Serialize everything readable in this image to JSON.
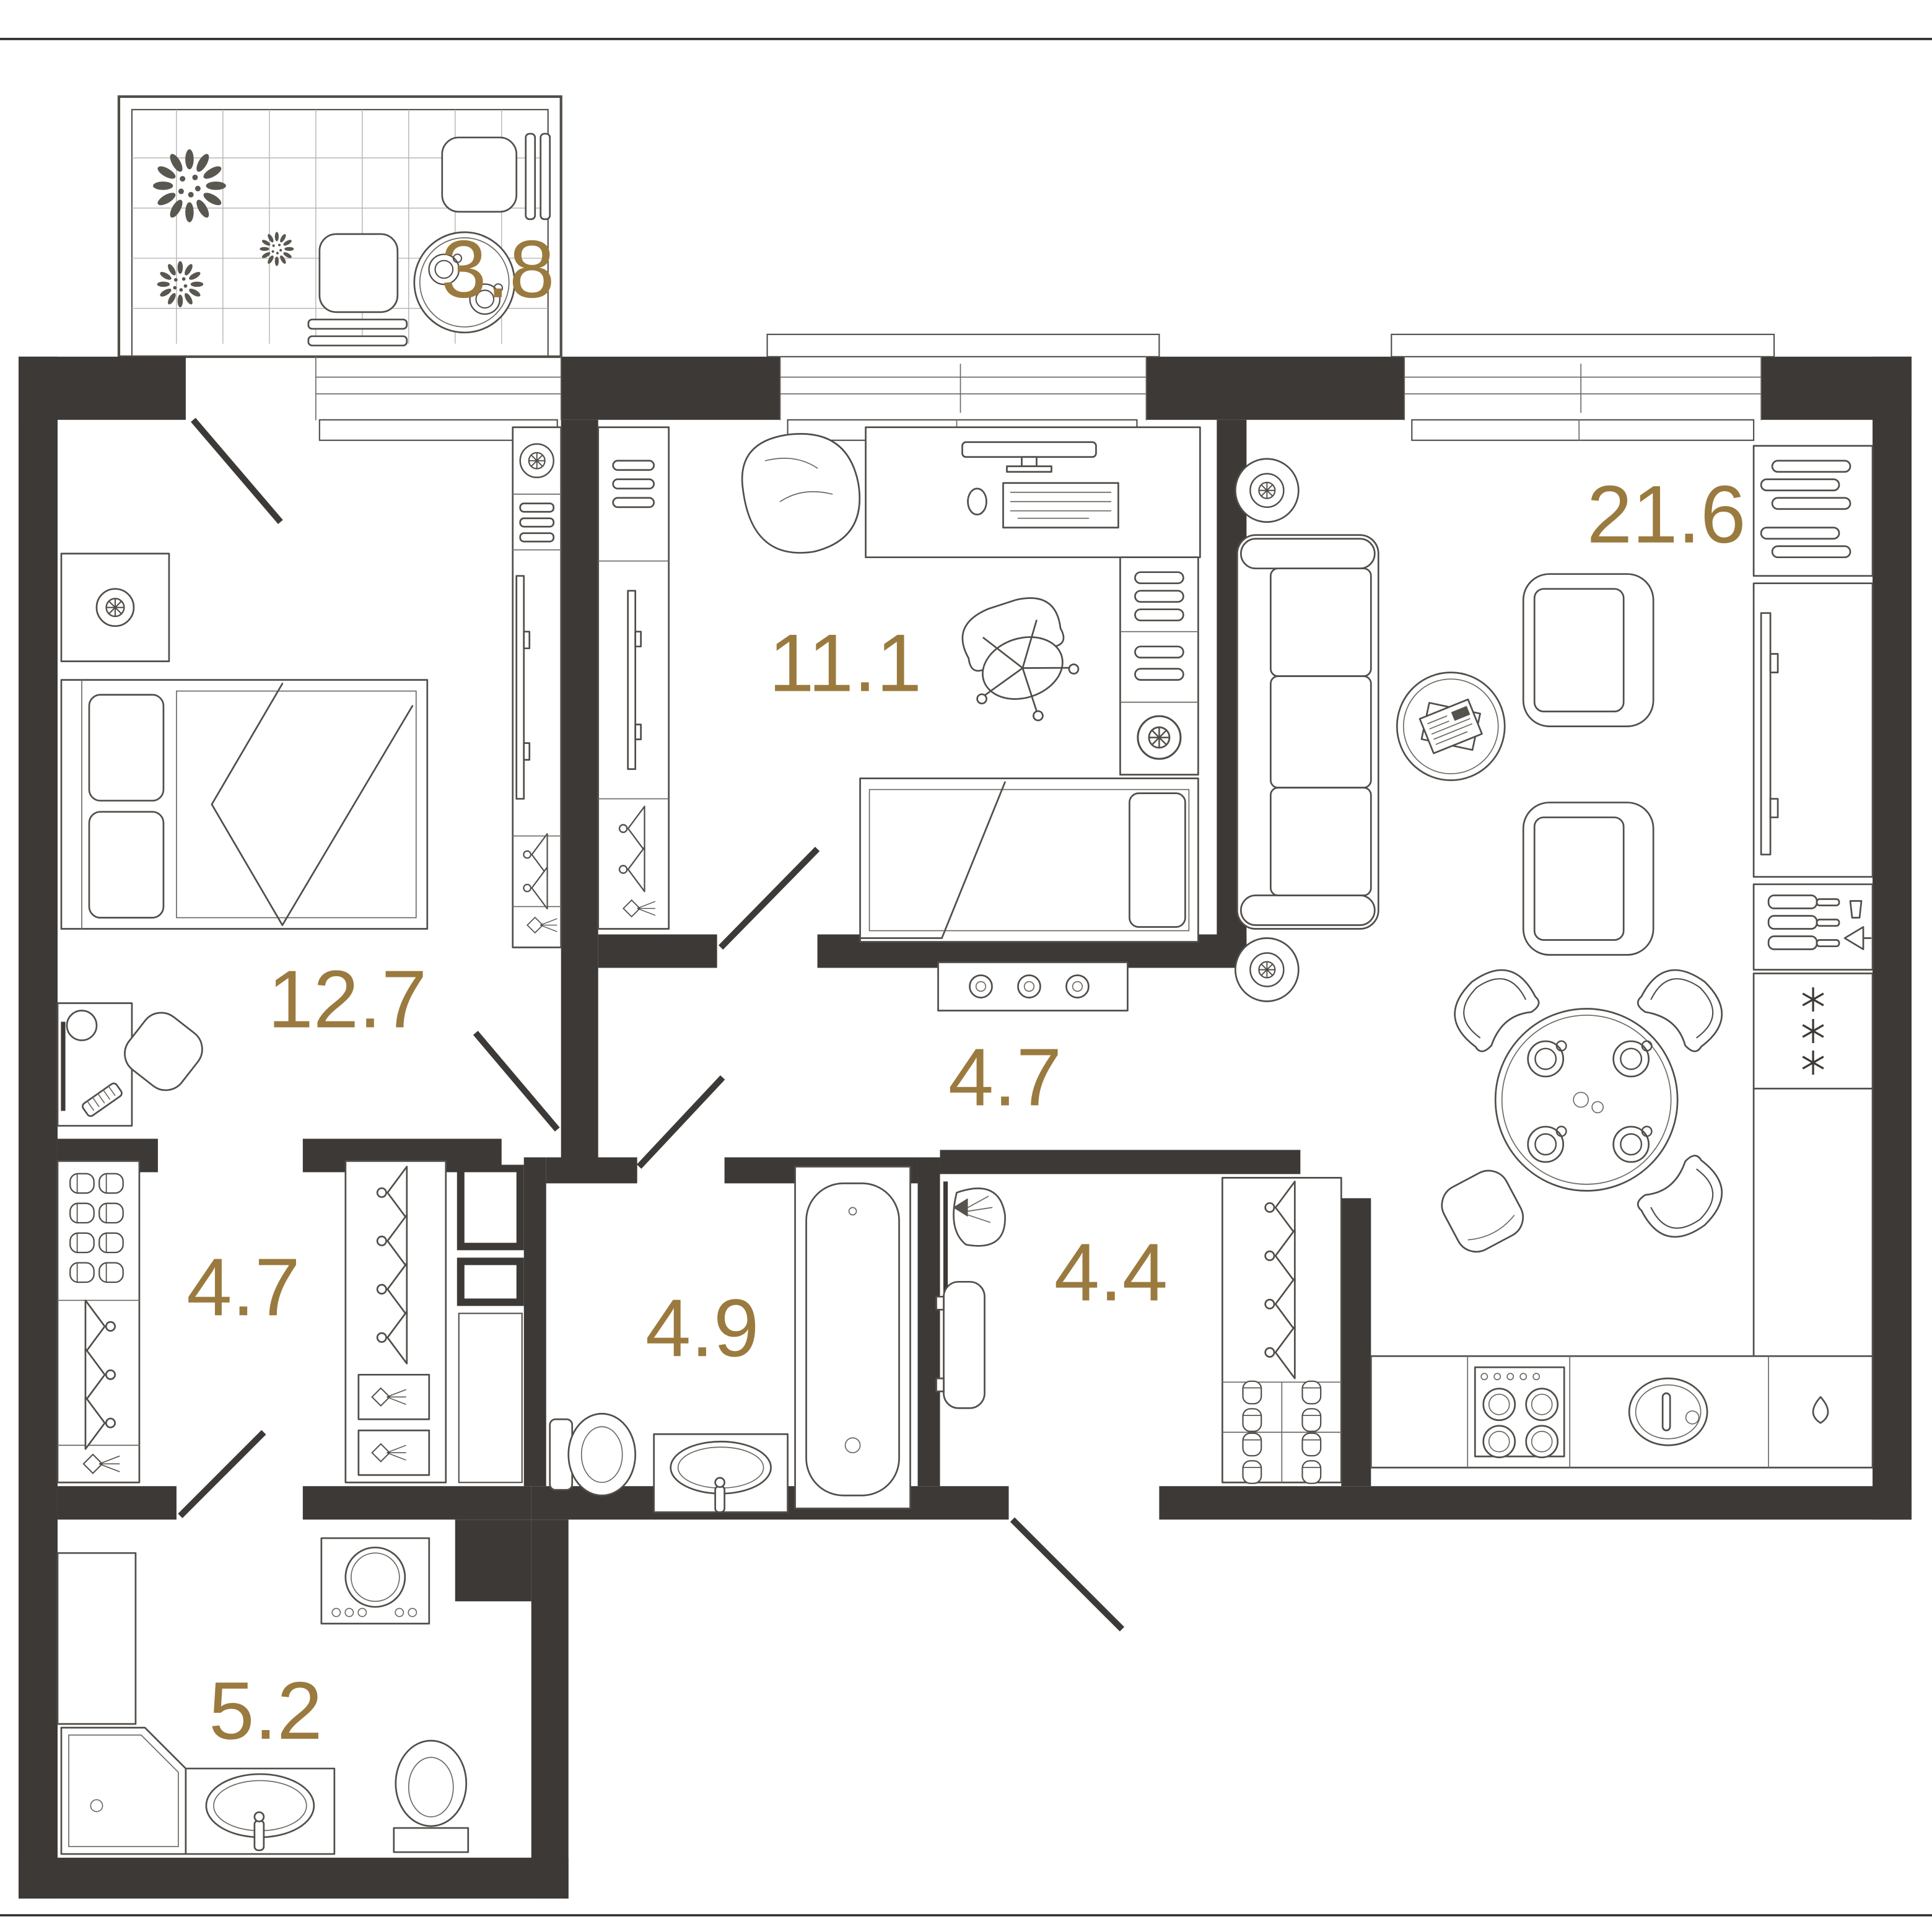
{
  "page": {
    "background": "#ffffff",
    "border_rule_color": "#2e2b29",
    "type": "apartment floor plan"
  },
  "plan": {
    "wall_color": "#3d3936",
    "furniture_line_color": "#514d49",
    "label_color": "#9a7a3e",
    "rooms": [
      {
        "id": "balcony",
        "area": "3.8"
      },
      {
        "id": "bedroom",
        "area": "12.7"
      },
      {
        "id": "child-room",
        "area": "11.1"
      },
      {
        "id": "living-kitchen",
        "area": "21.6"
      },
      {
        "id": "hallway",
        "area": "4.7"
      },
      {
        "id": "closet",
        "area": "4.7"
      },
      {
        "id": "bathroom",
        "area": "4.9"
      },
      {
        "id": "dressing-room",
        "area": "4.4"
      },
      {
        "id": "shower-room",
        "area": "5.2"
      }
    ],
    "icons": {
      "plant": "dandelion-burst",
      "ceiling-lamp": "circle-asterisk",
      "floor-lamp": "circle-asterisk-large",
      "hanger": "clothes-hanger",
      "slippers": "shoe-pair",
      "spotlight": "projector-cone",
      "snowflake": "asterisk",
      "cup": "double-circle-handle",
      "water-drop": "teardrop"
    }
  }
}
